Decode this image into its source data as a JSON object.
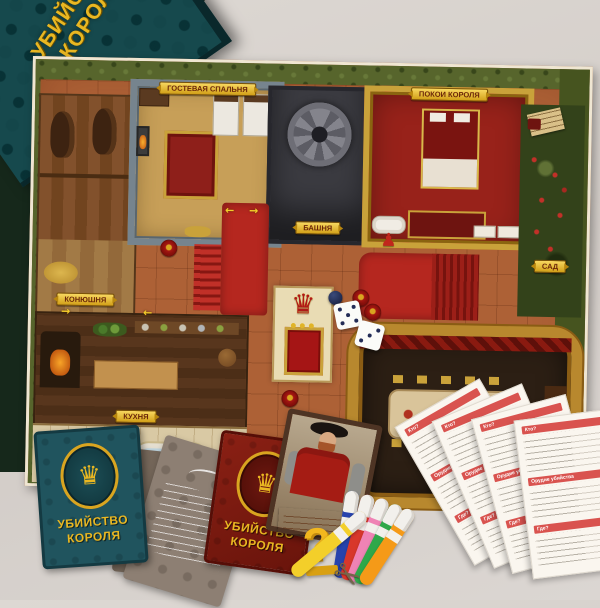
{
  "box": {
    "title_line1": "УБИЙСТВО",
    "title_line2": "КОРОЛЯ",
    "subtitle_fragment_1": "историй и",
    "subtitle_fragment_2": "ний!"
  },
  "board": {
    "rooms": {
      "guest_bedroom": "Гостевая спальня",
      "king_chambers": "Покои Короля",
      "tower": "Башня",
      "stable": "Конюшня",
      "kitchen": "Кухня",
      "privy": "Уборная",
      "garden": "Сад"
    }
  },
  "decks": {
    "blue_title_line1": "Убийство",
    "blue_title_line2": "Короля",
    "red_title_line1": "Убийство",
    "red_title_line2": "Короля"
  },
  "dice": {
    "die1": 5,
    "die2": 3
  },
  "note_sheet": {
    "section1": "Кто?",
    "section2": "Орудие убийства",
    "section3": "Где?"
  },
  "markers": {
    "colors": [
      "#2743ad",
      "#d8372b",
      "#ef83b5",
      "#2fa84a",
      "#f59a18",
      "#f3cf2a"
    ]
  },
  "icons": {
    "crown": "♛",
    "pawn": "♟",
    "scissors": "✂",
    "question_mark": "?",
    "arrow_right": "→",
    "arrow_left": "←"
  },
  "colors": {
    "board_floor": "#ad6136",
    "board_grass": "#57652c",
    "carpet_red": "#b5271f",
    "gold": "#d9a520",
    "sheet_header_red": "#d9534f",
    "blue_deck": "#20545e",
    "red_deck": "#7a180f",
    "box_teal": "#16494d"
  }
}
